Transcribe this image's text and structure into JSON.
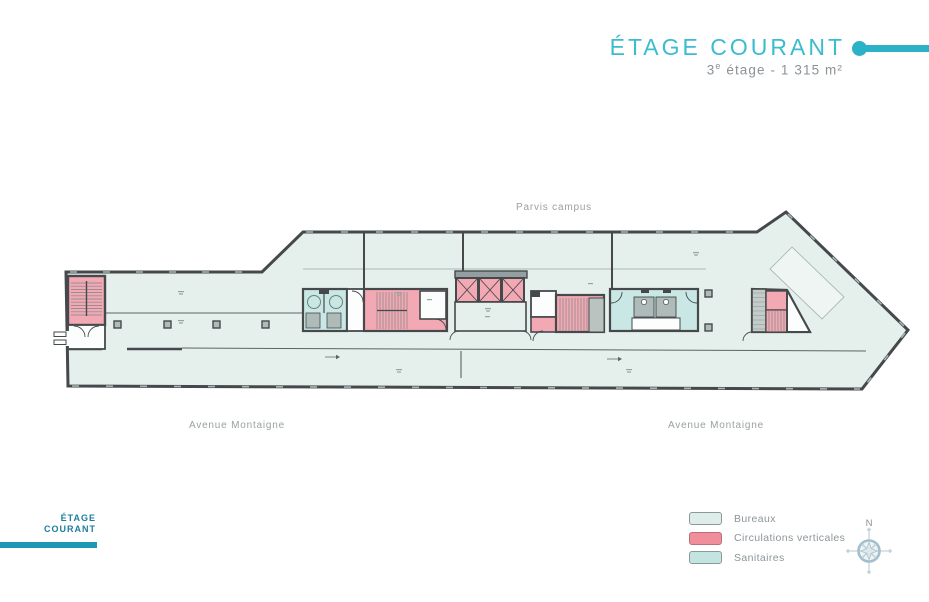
{
  "header": {
    "title": "ÉTAGE COURANT",
    "subtitle_num": "3",
    "subtitle_sup": "e",
    "subtitle_rest": " étage - 1 315 m²"
  },
  "plan": {
    "street_top": "Parvis campus",
    "street_bottom_left": "Avenue Montaigne",
    "street_bottom_right": "Avenue Montaigne",
    "colors": {
      "floor": "#e5f0ed",
      "wall": "#46494b",
      "circulation_pink": "#f3a9b4",
      "sanitary_teal": "#c9e7e4",
      "fixture_gray": "#aebbb8",
      "accent_teal": "#2bb2c7"
    }
  },
  "legend": {
    "items": [
      {
        "label": "Bureaux",
        "color": "#dfedea"
      },
      {
        "label": "Circulations verticales",
        "color": "#f08f9b"
      },
      {
        "label": "Sanitaires",
        "color": "#c4e4e1"
      }
    ],
    "compass_north": "N"
  },
  "footer_tab": {
    "line1": "ÉTAGE",
    "line2": "COURANT"
  }
}
